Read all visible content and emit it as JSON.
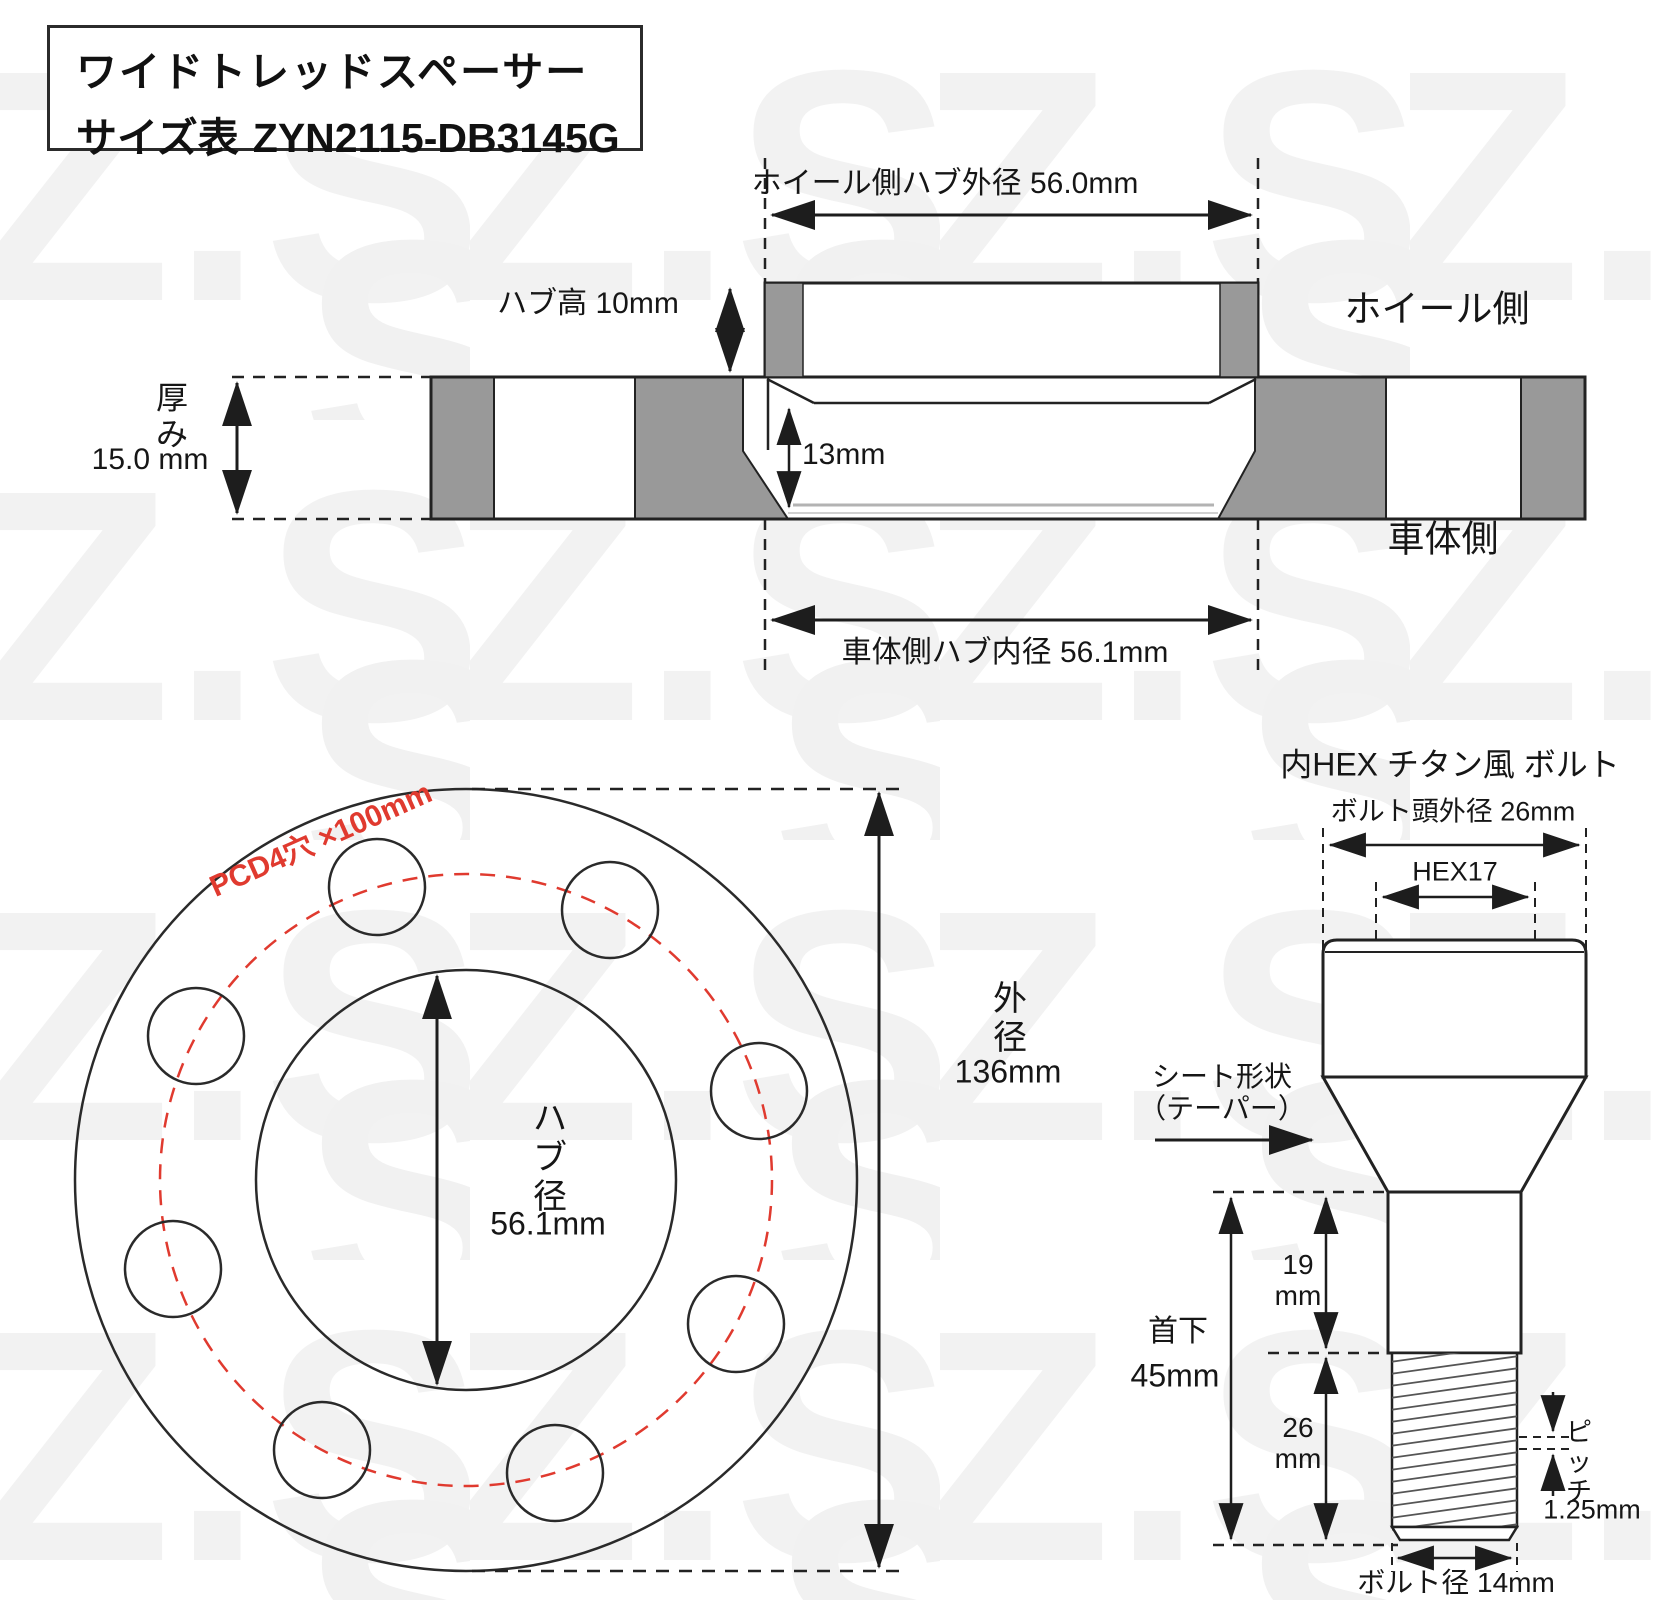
{
  "watermark": {
    "text": "Z.S.S."
  },
  "title": {
    "line1": "ワイドトレッドスペーサー",
    "line2_label": "サイズ表",
    "line2_code": "ZYN2115-DB3145G"
  },
  "cross_section": {
    "top_dim": "ホイール側ハブ外径 56.0mm",
    "hub_height": "ハブ高 10mm",
    "thickness_label": "厚み",
    "thickness_value": "15.0 mm",
    "bore_depth": "13mm",
    "bottom_dim": "車体側ハブ内径 56.1mm",
    "wheel_side": "ホイール側",
    "body_side": "車体側"
  },
  "front_view": {
    "pcd": "PCD4穴 ×100mm",
    "hub_dia_label": "ハブ径",
    "hub_dia_value": "56.1mm",
    "outer_dia_label": "外径",
    "outer_dia_value": "136mm"
  },
  "bolt": {
    "title": "内HEX チタン風 ボルト",
    "head_od": "ボルト頭外径 26mm",
    "hex": "HEX17",
    "seat_line1": "シート形状",
    "seat_line2": "（テーパー）",
    "len_upper_value": "19",
    "len_upper_unit": "mm",
    "len_lower_value": "26",
    "len_lower_unit": "mm",
    "neck_label": "首下",
    "neck_value": "45mm",
    "pitch_label": "ピッチ",
    "pitch_value": "1.25mm",
    "dia": "ボルト径 14mm"
  },
  "colors": {
    "line": "#222222",
    "gray_fill": "#999999",
    "accent_red": "#e03a2f",
    "watermark_gray": "#f1f1f1"
  }
}
